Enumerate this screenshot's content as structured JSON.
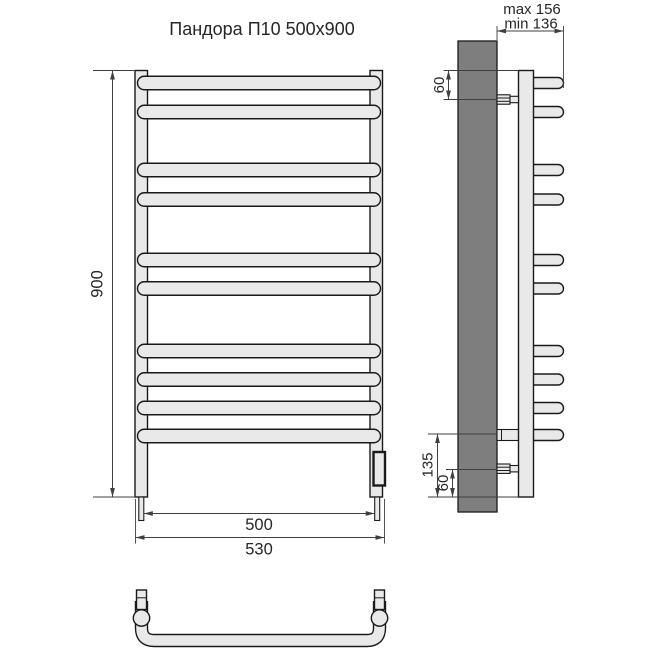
{
  "title": "Пандора П10 500x900",
  "views": {
    "front": {
      "name": "front-elevation",
      "height_dim": "900",
      "rail_width_dim": "500",
      "overall_width_dim": "530",
      "rung_count": 10
    },
    "side": {
      "name": "side-elevation",
      "wall_offset_max": "max 156",
      "wall_offset_min": "min 136",
      "top_bracket_offset": "60",
      "bottom_rung_offset": "135",
      "bottom_bracket_offset": "60"
    },
    "top": {
      "name": "plan-view-of-bottom-rung"
    }
  },
  "colors": {
    "tube_fill": "#e9e9e9",
    "wall_fill": "#7e7e7e",
    "outline": "#1a1a1a",
    "dimension_line": "#3f3f3f",
    "text": "#262626",
    "background": "#ffffff"
  },
  "geometry": {
    "front_rungs": {
      "x": 137.5,
      "width": 243,
      "height": 13.5,
      "centers_y": [
        83,
        112,
        170,
        199.5,
        260,
        288.5,
        351,
        379.5,
        408,
        436
      ]
    },
    "side_rungs": {
      "x": 527.5,
      "width": 36,
      "height": 11,
      "centers_y": [
        83,
        112,
        170,
        199.5,
        260,
        288.5,
        351,
        379.5,
        408,
        435
      ]
    }
  }
}
